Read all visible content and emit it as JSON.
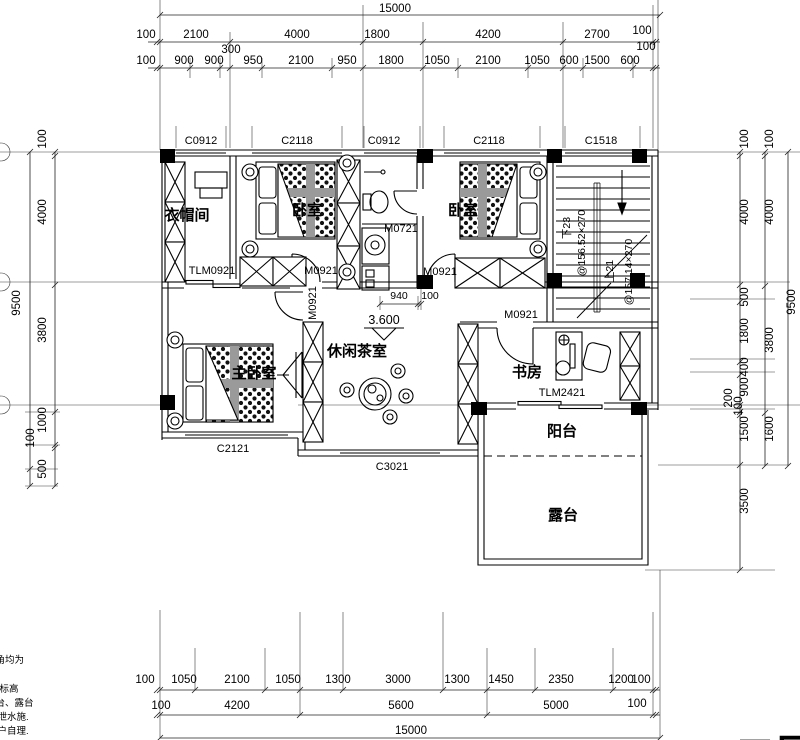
{
  "plan": {
    "rooms": [
      {
        "t": "衣帽间",
        "x": 187,
        "y": 220
      },
      {
        "t": "卧室",
        "x": 307,
        "y": 215
      },
      {
        "t": "卧室",
        "x": 463,
        "y": 215
      },
      {
        "t": "主卧室",
        "x": 254,
        "y": 378
      },
      {
        "t": "休闲茶室",
        "x": 357,
        "y": 356
      },
      {
        "t": "书房",
        "x": 527,
        "y": 377
      },
      {
        "t": "阳台",
        "x": 562,
        "y": 436
      },
      {
        "t": "露台",
        "x": 563,
        "y": 520
      }
    ],
    "openings": [
      {
        "t": "C0912",
        "x": 201,
        "y": 144
      },
      {
        "t": "C2118",
        "x": 297,
        "y": 144
      },
      {
        "t": "C0912",
        "x": 384,
        "y": 144
      },
      {
        "t": "C2118",
        "x": 489,
        "y": 144
      },
      {
        "t": "C1518",
        "x": 601,
        "y": 144
      },
      {
        "t": "M0721",
        "x": 401,
        "y": 232
      },
      {
        "t": "TLM0921",
        "x": 212,
        "y": 274
      },
      {
        "t": "M0921",
        "x": 321,
        "y": 274
      },
      {
        "t": "M0921",
        "x": 440,
        "y": 275
      },
      {
        "t": "M0921",
        "x": 316,
        "y": 303,
        "r": -90
      },
      {
        "t": "M0921",
        "x": 521,
        "y": 318
      },
      {
        "t": "TLM2421",
        "x": 562,
        "y": 396
      },
      {
        "t": "C2121",
        "x": 233,
        "y": 452
      },
      {
        "t": "C3021",
        "x": 392,
        "y": 470
      }
    ],
    "level": {
      "t": "3.600",
      "x": 384,
      "y": 324
    },
    "dims_small": [
      {
        "t": "940",
        "x": 399,
        "y": 299
      },
      {
        "t": "100",
        "x": 430,
        "y": 299
      }
    ],
    "stair_notes": [
      {
        "t": "下23",
        "x": 570,
        "y": 228,
        "r": -90
      },
      {
        "t": "@156.52×270",
        "x": 585,
        "y": 243,
        "r": -90
      },
      {
        "t": "上21",
        "x": 613,
        "y": 271,
        "r": -90
      },
      {
        "t": "@157.14×270",
        "x": 632,
        "y": 272,
        "r": -90
      }
    ],
    "dims_top": [
      {
        "t": "15000",
        "x": 395,
        "y": 12
      },
      {
        "t": "100",
        "x": 146,
        "y": 38
      },
      {
        "t": "2100",
        "x": 196,
        "y": 38
      },
      {
        "t": "4000",
        "x": 297,
        "y": 38
      },
      {
        "t": "1800",
        "x": 377,
        "y": 38
      },
      {
        "t": "4200",
        "x": 488,
        "y": 38
      },
      {
        "t": "2700",
        "x": 597,
        "y": 38
      },
      {
        "t": "100",
        "x": 642,
        "y": 34
      },
      {
        "t": "300",
        "x": 231,
        "y": 53
      },
      {
        "t": "100",
        "x": 646,
        "y": 50
      },
      {
        "t": "100",
        "x": 146,
        "y": 64
      },
      {
        "t": "900",
        "x": 184,
        "y": 64
      },
      {
        "t": "900",
        "x": 214,
        "y": 64
      },
      {
        "t": "950",
        "x": 253,
        "y": 64
      },
      {
        "t": "2100",
        "x": 301,
        "y": 64
      },
      {
        "t": "950",
        "x": 347,
        "y": 64
      },
      {
        "t": "1800",
        "x": 391,
        "y": 64
      },
      {
        "t": "1050",
        "x": 437,
        "y": 64
      },
      {
        "t": "2100",
        "x": 488,
        "y": 64
      },
      {
        "t": "1050",
        "x": 537,
        "y": 64
      },
      {
        "t": "600",
        "x": 569,
        "y": 64
      },
      {
        "t": "1500",
        "x": 597,
        "y": 64
      },
      {
        "t": "600",
        "x": 630,
        "y": 64
      }
    ],
    "dims_bottom": [
      {
        "t": "100",
        "x": 145,
        "y": 683
      },
      {
        "t": "1050",
        "x": 184,
        "y": 683
      },
      {
        "t": "2100",
        "x": 237,
        "y": 683
      },
      {
        "t": "1050",
        "x": 288,
        "y": 683
      },
      {
        "t": "1300",
        "x": 338,
        "y": 683
      },
      {
        "t": "3000",
        "x": 398,
        "y": 683
      },
      {
        "t": "1300",
        "x": 457,
        "y": 683
      },
      {
        "t": "1450",
        "x": 501,
        "y": 683
      },
      {
        "t": "2350",
        "x": 561,
        "y": 683
      },
      {
        "t": "1200",
        "x": 621,
        "y": 683
      },
      {
        "t": "100",
        "x": 641,
        "y": 683
      },
      {
        "t": "100",
        "x": 161,
        "y": 709
      },
      {
        "t": "4200",
        "x": 237,
        "y": 709
      },
      {
        "t": "5600",
        "x": 401,
        "y": 709
      },
      {
        "t": "5000",
        "x": 556,
        "y": 709
      },
      {
        "t": "100",
        "x": 637,
        "y": 707
      },
      {
        "t": "15000",
        "x": 411,
        "y": 734
      }
    ],
    "dims_left": [
      {
        "t": "9500",
        "x": 20,
        "y": 303
      },
      {
        "t": "100",
        "x": 46,
        "y": 139
      },
      {
        "t": "4000",
        "x": 46,
        "y": 212
      },
      {
        "t": "3800",
        "x": 46,
        "y": 330
      },
      {
        "t": "1000",
        "x": 46,
        "y": 420
      },
      {
        "t": "100",
        "x": 34,
        "y": 438
      },
      {
        "t": "500",
        "x": 46,
        "y": 469
      }
    ],
    "dims_right": [
      {
        "t": "100",
        "x": 748,
        "y": 139
      },
      {
        "t": "4000",
        "x": 748,
        "y": 212
      },
      {
        "t": "500",
        "x": 748,
        "y": 297
      },
      {
        "t": "1800",
        "x": 748,
        "y": 331
      },
      {
        "t": "400",
        "x": 748,
        "y": 367
      },
      {
        "t": "900",
        "x": 748,
        "y": 387
      },
      {
        "t": "200",
        "x": 732,
        "y": 398
      },
      {
        "t": "100",
        "x": 742,
        "y": 406
      },
      {
        "t": "1500",
        "x": 748,
        "y": 429
      },
      {
        "t": "3500",
        "x": 748,
        "y": 501
      },
      {
        "t": "100",
        "x": 773,
        "y": 139
      },
      {
        "t": "4000",
        "x": 773,
        "y": 212
      },
      {
        "t": "3800",
        "x": 773,
        "y": 340
      },
      {
        "t": "1600",
        "x": 773,
        "y": 429
      },
      {
        "t": "9500",
        "x": 795,
        "y": 302
      }
    ],
    "corner_notes": [
      {
        "t": "地角均为",
        "x": -14,
        "y": 663
      },
      {
        "t": "层标高",
        "x": -10,
        "y": 692
      },
      {
        "t": "阳台、露台",
        "x": -14,
        "y": 706
      },
      {
        "t": "置泄水施.",
        "x": -12,
        "y": 720
      },
      {
        "t": "用户自理.",
        "x": -12,
        "y": 734
      }
    ],
    "floor_tag": {
      "t": "二层",
      "x": 775,
      "y": 768
    }
  }
}
